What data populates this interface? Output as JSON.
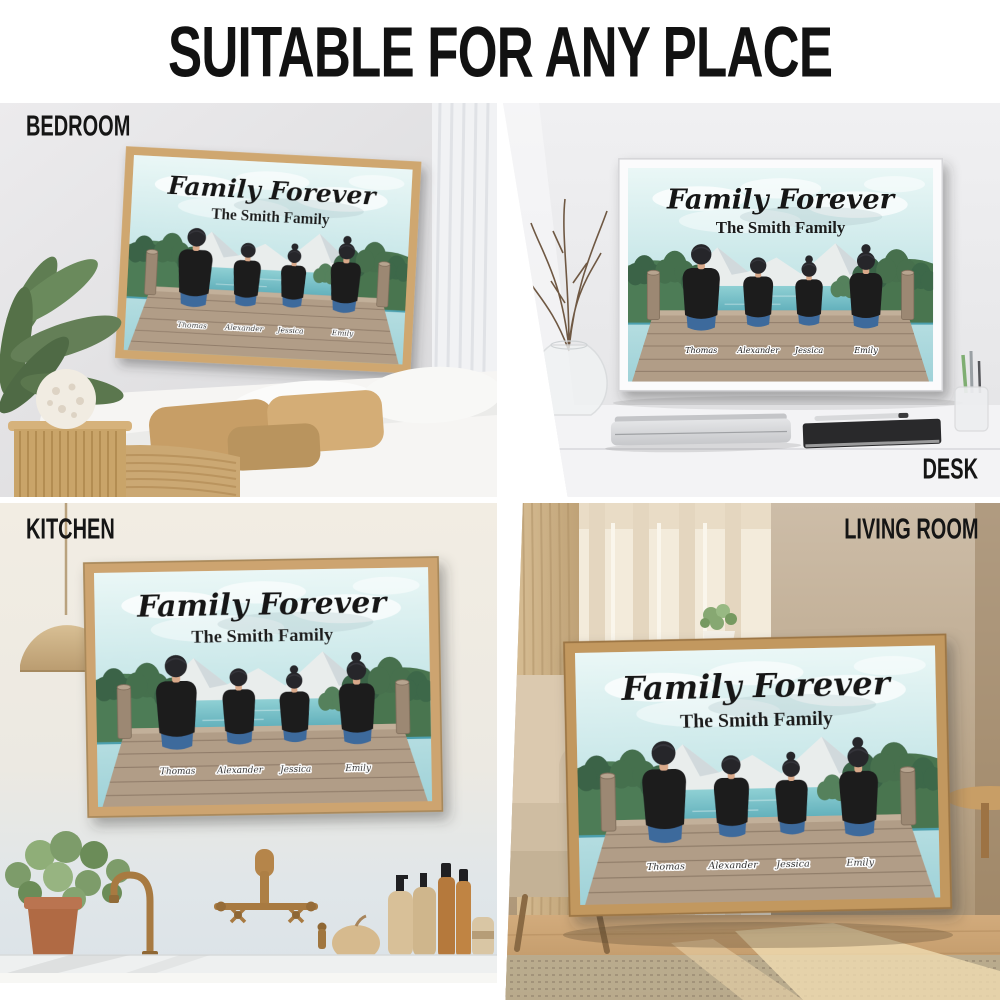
{
  "header": {
    "title": "SUITABLE FOR ANY PLACE"
  },
  "poster": {
    "title": "Family Forever",
    "subtitle": "The Smith Family",
    "names": [
      "Thomas",
      "Alexander",
      "Jessica",
      "Emily"
    ]
  },
  "scenes": [
    {
      "id": "bedroom",
      "label": "BEDROOM"
    },
    {
      "id": "desk",
      "label": "DESK"
    },
    {
      "id": "kitchen",
      "label": "KITCHEN"
    },
    {
      "id": "living-room",
      "label": "LIVING ROOM"
    }
  ],
  "colors": {
    "background": "#ffffff",
    "header_text": "#121212",
    "poster_sky": "#c2e4e6",
    "poster_lake": "#4a9fae",
    "poster_dock_wood": "#b19d87",
    "shirt": "#1a1a1e",
    "jeans": "#3e6b9c",
    "frame_wood": "#cfa76f",
    "frame_white": "#fafafa"
  }
}
